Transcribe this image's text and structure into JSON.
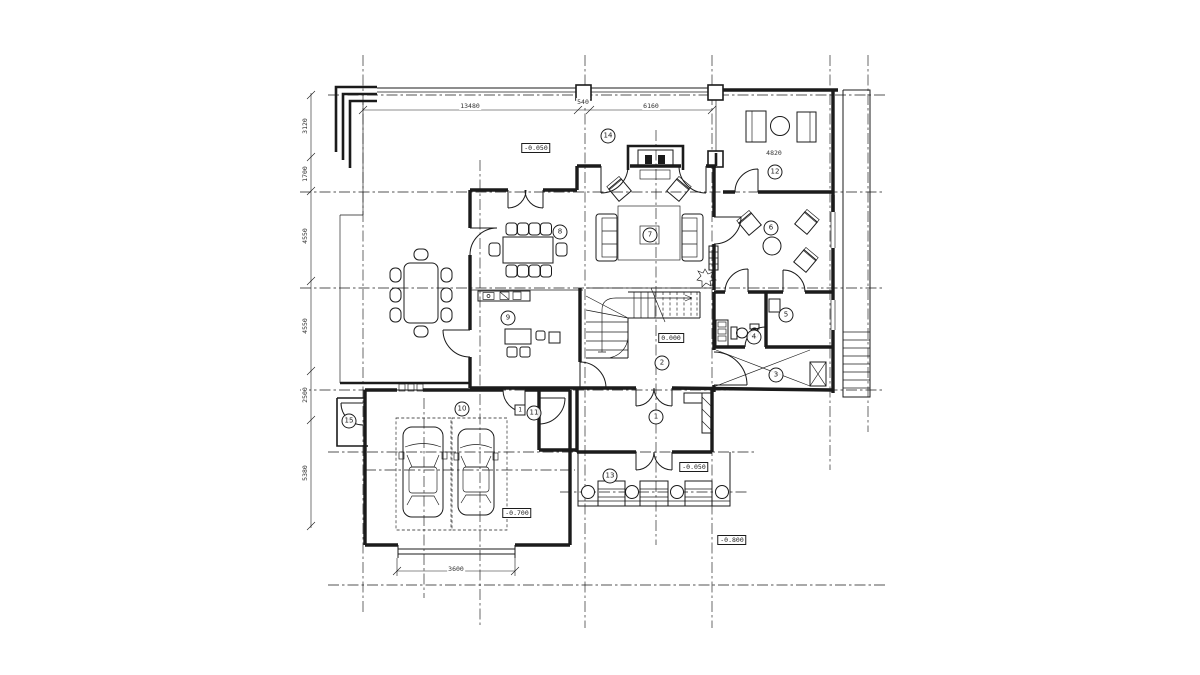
{
  "drawing": {
    "type": "architectural ground floor plan",
    "background": "#ffffff",
    "line_color": "#1b1b1b"
  },
  "rooms": [
    {
      "number": "1"
    },
    {
      "number": "2"
    },
    {
      "number": "3"
    },
    {
      "number": "4"
    },
    {
      "number": "5"
    },
    {
      "number": "6"
    },
    {
      "number": "7"
    },
    {
      "number": "8"
    },
    {
      "number": "9"
    },
    {
      "number": "10"
    },
    {
      "number": "11"
    },
    {
      "number": "12"
    },
    {
      "number": "13"
    },
    {
      "number": "14"
    },
    {
      "number": "15"
    }
  ],
  "elevations": [
    {
      "value": "-0.050"
    },
    {
      "value": "0.000"
    },
    {
      "value": "-0.050"
    },
    {
      "value": "-0.700"
    },
    {
      "value": "-0.800"
    }
  ],
  "dimensions": {
    "left_chain": [
      "3120",
      "1700",
      "4550",
      "4550",
      "2500",
      "5380"
    ],
    "top_chain": [
      "13480",
      "540",
      "6160"
    ],
    "garage_door_width": "3600",
    "room12_width": "4820"
  },
  "tags": {
    "door_tag": "1"
  }
}
